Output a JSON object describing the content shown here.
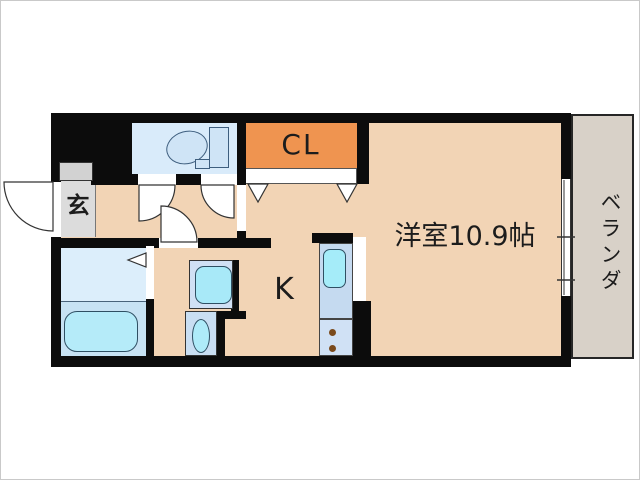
{
  "plan": {
    "type": "apartment-floor-plan",
    "labels": {
      "entrance": "玄",
      "closet": "CL",
      "western_room": "洋室10.9帖",
      "kitchen": "K",
      "veranda": "ベランダ"
    },
    "icons": {
      "toilet": "toilet-icon",
      "bathtub": "bathtub-icon",
      "washing_machine_pan": "washing-machine-pan-icon",
      "washbasin": "washbasin-icon",
      "kitchen_sink": "kitchen-sink-icon",
      "stove_burners": "stove-burners-icon",
      "door_swings": "door-swing-arc-icon",
      "closet_folding_doors": "folding-door-triangle-icon",
      "sliding_window": "sliding-window-icon"
    },
    "colors": {
      "wall": "#0c0c0c",
      "floor": "#f2d4b5",
      "closet": "#ef9450",
      "toilet_room": "#d9ebfa",
      "fixture_blue": "#cfe4f6",
      "bath_upper": "#dceefb",
      "bath_lower": "#c7e2f3",
      "tub": "#b5ebf9",
      "wm_pan": "#d0e0f4",
      "wm_inner": "#a8e9f8",
      "sink_unit": "#c9def2",
      "basin": "#aeebf9",
      "counter_upper": "#c5daf0",
      "counter_lower": "#d0e1f5",
      "counter_sink": "#a5ecf9",
      "burner": "#7a4a1c",
      "veranda": "#d8d1c8",
      "entrance_gray": "#dcdcdc",
      "cabinet_gray": "#d2d2d2"
    }
  }
}
